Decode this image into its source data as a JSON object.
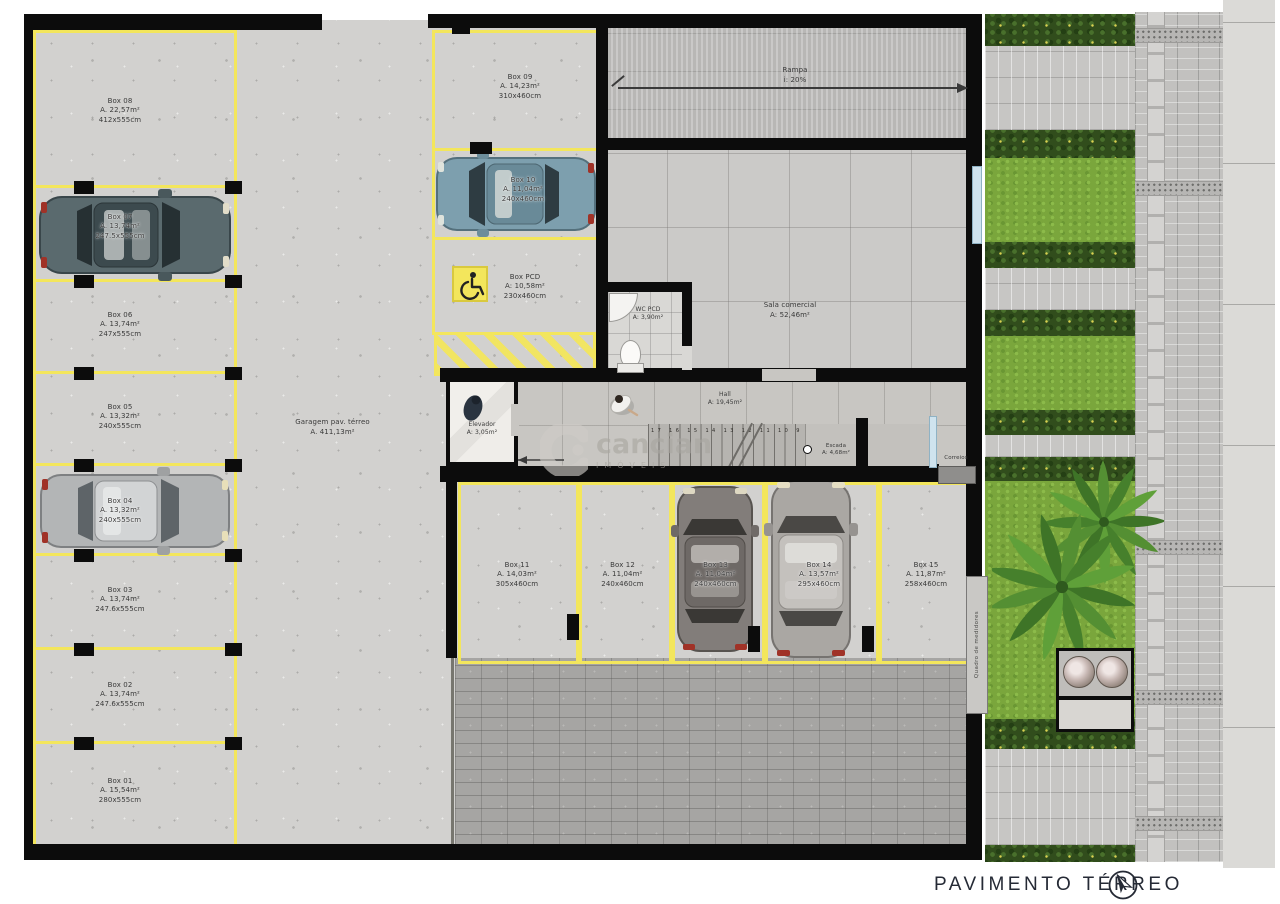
{
  "footer": {
    "title": "PAVIMENTO TÉRREO"
  },
  "watermark": {
    "brand": "cancian",
    "sub": "IMÓVEIS"
  },
  "areas": {
    "garagem": {
      "line1": "Garagem pav. térreo",
      "line2": "A. 411,13m²"
    },
    "rampa": {
      "line1": "Rampa",
      "line2": "i: 20%"
    },
    "sala": {
      "line1": "Sala comercial",
      "line2": "A: 52,46m²"
    },
    "wc": {
      "line1": "WC PCD",
      "line2": "A: 3,90m²"
    },
    "hall": {
      "line1": "Hall",
      "line2": "A: 19,45m²"
    },
    "elevador": {
      "line1": "Elevador",
      "line2": "A: 3,05m²"
    },
    "escada": {
      "line1": "Escada",
      "line2": "A: 4,68m²",
      "steps": "17 16 15 14 13 12 11 10 9 8 7 6 5 4 3 2 1"
    },
    "correios": {
      "label": "Correios"
    },
    "medidores": {
      "label": "Quadro de medidores"
    }
  },
  "boxes": {
    "b01": {
      "name": "Box 01",
      "area": "A. 15,54m²",
      "size": "280x555cm"
    },
    "b02": {
      "name": "Box 02",
      "area": "A. 13,74m²",
      "size": "247.6x555cm"
    },
    "b03": {
      "name": "Box 03",
      "area": "A. 13,74m²",
      "size": "247.6x555cm"
    },
    "b04": {
      "name": "Box 04",
      "area": "A. 13,32m²",
      "size": "240x555cm"
    },
    "b05": {
      "name": "Box 05",
      "area": "A. 13,32m²",
      "size": "240x555cm"
    },
    "b06": {
      "name": "Box 06",
      "area": "A. 13,74m²",
      "size": "247x555cm"
    },
    "b07": {
      "name": "Box 07",
      "area": "A. 13,74m²",
      "size": "247.5x555cm"
    },
    "b08": {
      "name": "Box 08",
      "area": "A. 22,57m²",
      "size": "412x555cm"
    },
    "b09": {
      "name": "Box 09",
      "area": "A. 14,23m²",
      "size": "310x460cm"
    },
    "b10": {
      "name": "Box 10",
      "area": "A. 11,04m²",
      "size": "240x460cm"
    },
    "bpcd": {
      "name": "Box PCD",
      "area": "A: 10,58m²",
      "size": "230x460cm"
    },
    "b11": {
      "name": "Box 11",
      "area": "A. 14,03m²",
      "size": "305x460cm"
    },
    "b12": {
      "name": "Box 12",
      "area": "A. 11,04m²",
      "size": "240x460cm"
    },
    "b13": {
      "name": "Box 13",
      "area": "A. 11,04m²",
      "size": "240x460cm"
    },
    "b14": {
      "name": "Box 14",
      "area": "A. 13,57m²",
      "size": "295x460cm"
    },
    "b15": {
      "name": "Box 15",
      "area": "A. 11,87m²",
      "size": "258x460cm"
    }
  },
  "colors": {
    "stall_line": "#f3e65c",
    "wall": "#0c0c0c",
    "grass": "#7aa63c",
    "hedge": "#314d1c",
    "title": "#252a35"
  }
}
